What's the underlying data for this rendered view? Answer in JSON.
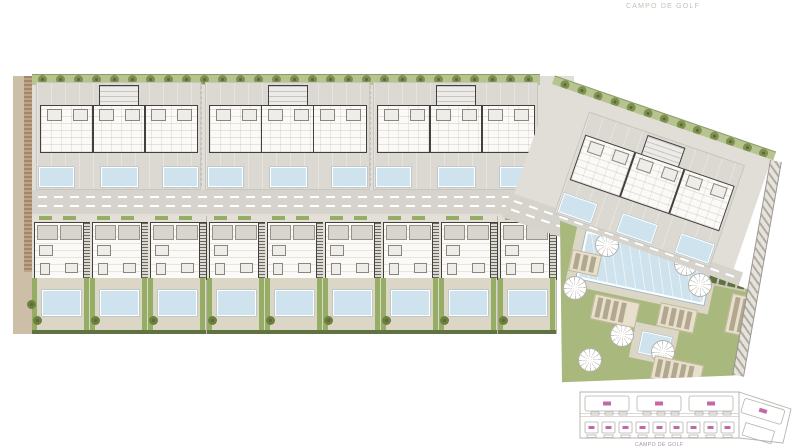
{
  "labels": {
    "golf_top": "CAMPO DE GOLF",
    "golf_key": "CAMPO DE GOLF"
  },
  "colors": {
    "paper": "#ffffff",
    "platform": "#e1ded7",
    "terrace": "#dcd9d2",
    "road": "#d6d3cc",
    "road-dash": "#ffffff",
    "wall": "#43413d",
    "room": "#fbfaf7",
    "roof": "#d8d5cf",
    "pool": "#cfe3ee",
    "pool-line": "#9cb9c9",
    "lawn": "#a9b87d",
    "lawn-strip": "#95ad64",
    "hedge": "#5f7340",
    "tree": "#7e9150",
    "tree-dark": "#5a6b33",
    "tan": "#cdbfa7",
    "brown": "#a3866b",
    "pad": "#e8e0cd",
    "pad-item": "#b2a88f",
    "paving": "#dcd6c6",
    "key-line": "#b7b2ac",
    "key-label": "#c468a8",
    "key-text": "#a5929e",
    "faint-text": "#c6bfb6"
  },
  "counts": {
    "upper_blocks": 3,
    "pools_per_block": 3,
    "townhouses": 9,
    "top_trees": 28,
    "diagonal_trees": 13,
    "palm_trees": 8,
    "key_top_units": 3,
    "key_bottom_units": 9
  },
  "elements": {
    "palms": [
      [
        49,
        31
      ],
      [
        128,
        50
      ],
      [
        17,
        74
      ],
      [
        142,
        71
      ],
      [
        64,
        121
      ],
      [
        105,
        138
      ],
      [
        187,
        104
      ],
      [
        32,
        146
      ]
    ],
    "lounger_pads": [
      [
        12,
        38,
        28,
        20
      ],
      [
        34,
        84,
        44,
        24
      ],
      [
        100,
        92,
        36,
        22
      ],
      [
        170,
        82,
        30,
        38
      ],
      [
        94,
        146,
        48,
        22
      ],
      [
        140,
        26,
        26,
        18
      ]
    ]
  }
}
